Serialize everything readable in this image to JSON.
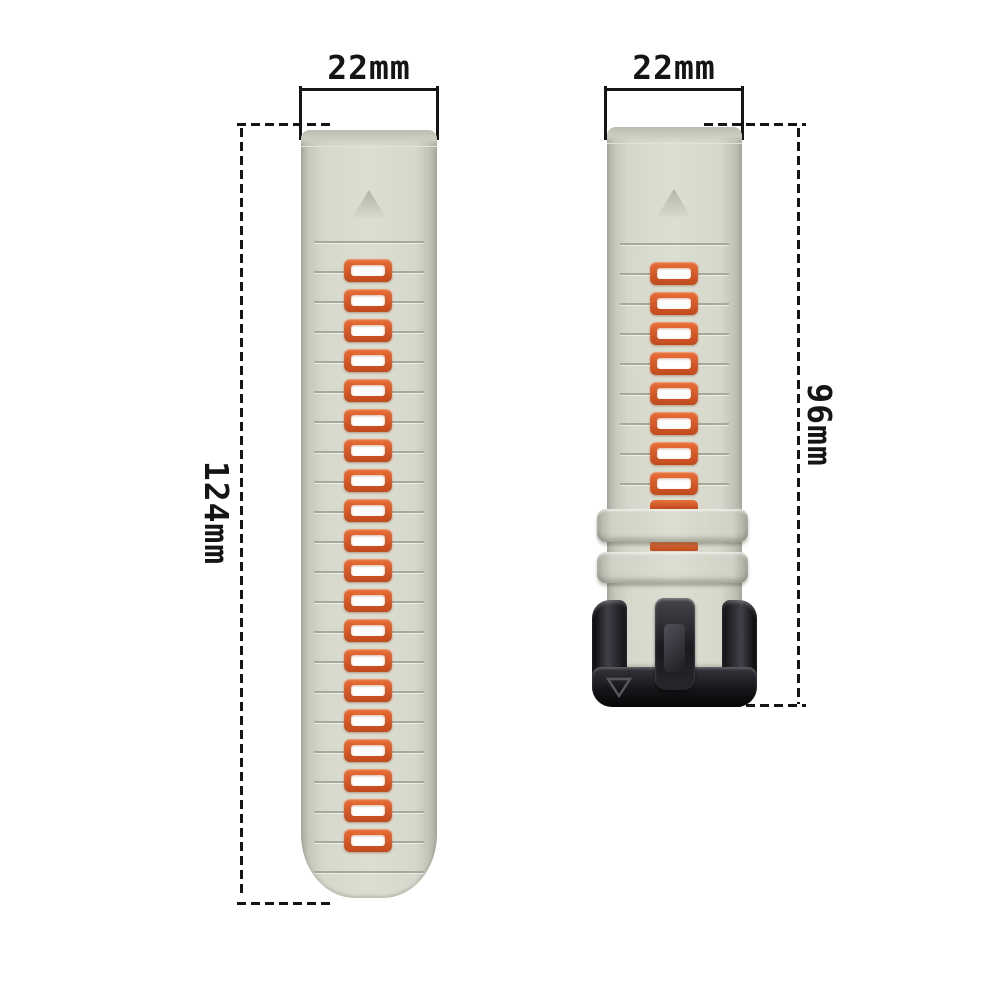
{
  "figure": {
    "description": "Two-piece silicone quick-release watch band shown with size annotations",
    "background": "#ffffff"
  },
  "annotations": {
    "left_strap_width": "22mm",
    "right_strap_width": "22mm",
    "left_strap_length": "124mm",
    "right_strap_length": "96mm"
  },
  "left_strap": {
    "hole_count": 20,
    "groove_count": 22,
    "marker_icon": "triangle-up"
  },
  "right_strap": {
    "hole_count": 8,
    "groove_count": 9,
    "marker_icon": "triangle-up",
    "keeper_loop_count": 2,
    "buckle_logo_icon": "v-outline"
  },
  "colors": {
    "strap_light": "#dcded1",
    "strap_mid": "#d6d8cb",
    "strap_edge": "#a9ac9f",
    "groove": "#a6a99b",
    "hole_accent": "#d95b28",
    "hole_fill": "#ffffff",
    "buckle_black": "#141417",
    "annotation_ink": "#151515"
  }
}
